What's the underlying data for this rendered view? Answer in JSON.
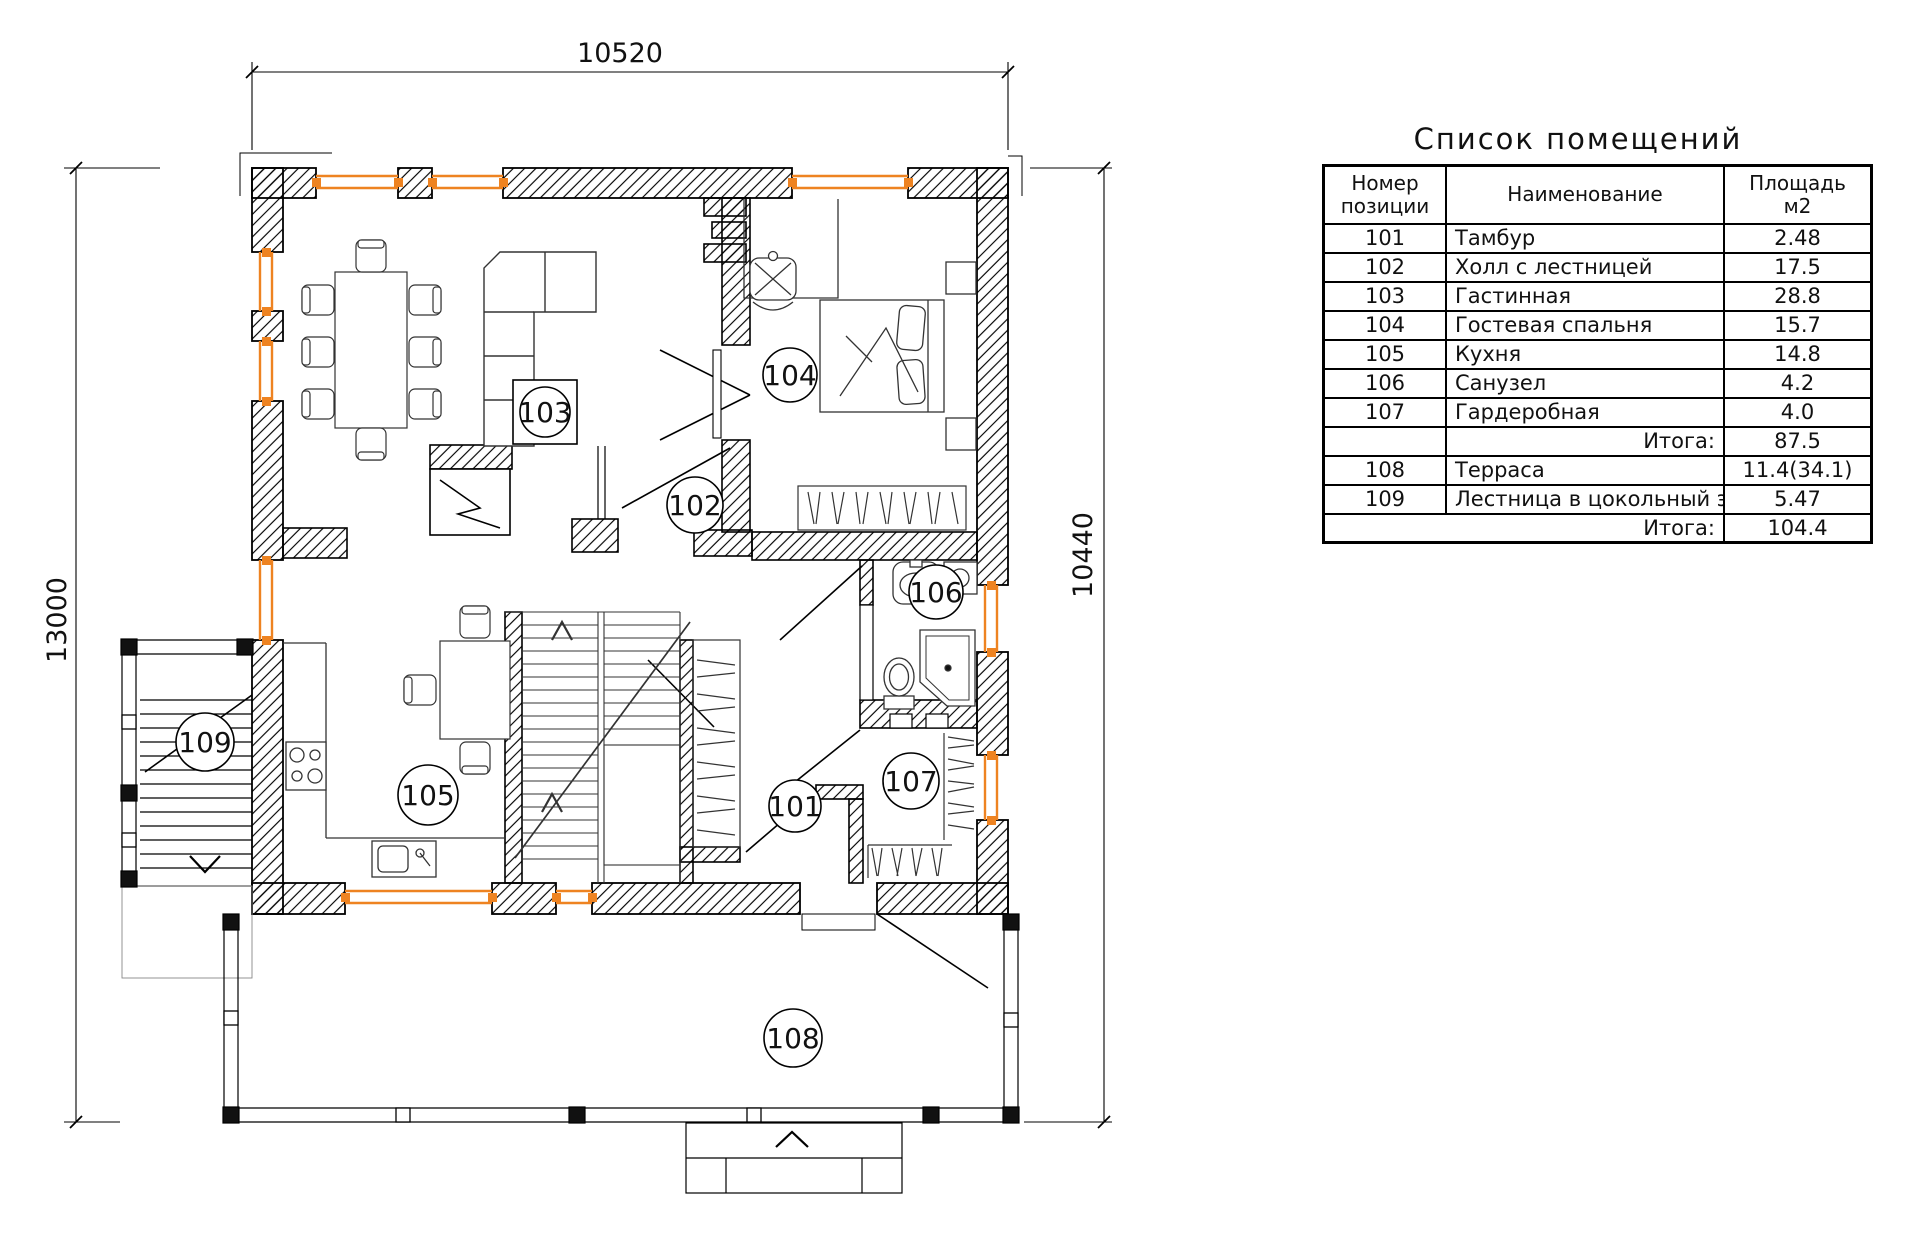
{
  "colors": {
    "accent_orange": "#ee8321",
    "line": "#000000"
  },
  "plan": {
    "dim_top": "10520",
    "dim_left": "13000",
    "dim_right": "10440",
    "labels": {
      "r101": "101",
      "r102": "102",
      "r103": "103",
      "r104": "104",
      "r105": "105",
      "r106": "106",
      "r107": "107",
      "r108": "108",
      "r109": "109"
    }
  },
  "table": {
    "title": "Список помещений",
    "headers": {
      "num": "Номер позиции",
      "name": "Наименование",
      "area": "Площадь м2"
    },
    "rows": [
      {
        "num": "101",
        "name": "Тамбур",
        "area": "2.48"
      },
      {
        "num": "102",
        "name": "Холл с лестницей",
        "area": "17.5"
      },
      {
        "num": "103",
        "name": "Гастинная",
        "area": "28.8"
      },
      {
        "num": "104",
        "name": "Гостевая спальня",
        "area": "15.7"
      },
      {
        "num": "105",
        "name": "Кухня",
        "area": "14.8"
      },
      {
        "num": "106",
        "name": "Санузел",
        "area": "4.2"
      },
      {
        "num": "107",
        "name": "Гардеробная",
        "area": "4.0"
      }
    ],
    "subtotal_label": "Итога:",
    "subtotal": "87.5",
    "rows2": [
      {
        "num": "108",
        "name": "Терраса",
        "area": "11.4(34.1)"
      },
      {
        "num": "109",
        "name": "Лестница в цокольный эт.",
        "area": "5.47"
      }
    ],
    "total_label": "Итога:",
    "total": "104.4"
  }
}
